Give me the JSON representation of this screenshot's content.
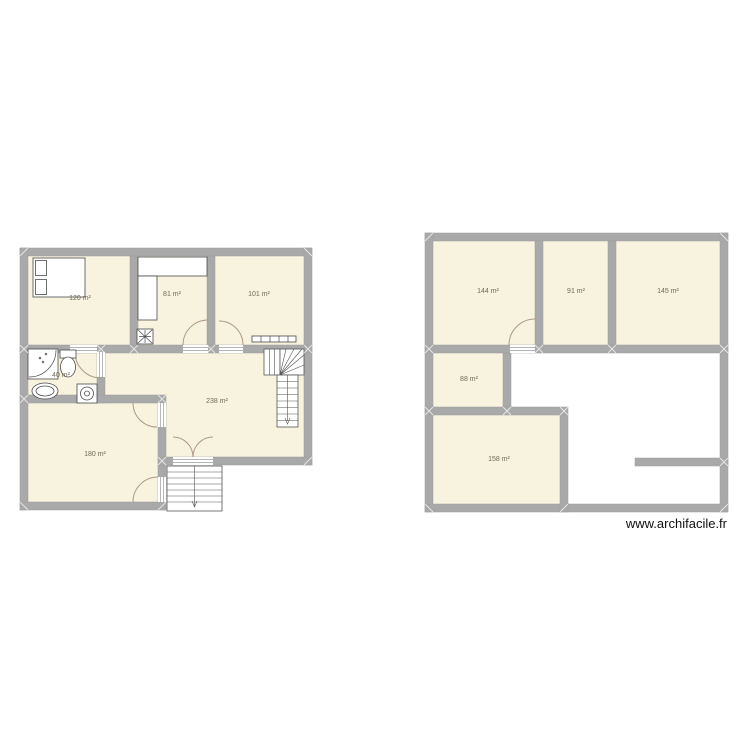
{
  "watermark": "www.archifacile.fr",
  "colors": {
    "wall": "#a9a9a9",
    "room_fill": "#f8f3de",
    "background": "#ffffff",
    "door_arc": "#ab9a85",
    "label_text": "#6e6a5a"
  },
  "floor_plan_left": {
    "rooms": [
      {
        "area_label": "120 m²"
      },
      {
        "area_label": "81 m²"
      },
      {
        "area_label": "101 m²"
      },
      {
        "area_label": "40 m²"
      },
      {
        "area_label": "238 m²"
      },
      {
        "area_label": "180 m²"
      }
    ]
  },
  "floor_plan_right": {
    "rooms": [
      {
        "area_label": "144 m²"
      },
      {
        "area_label": "91 m²"
      },
      {
        "area_label": "145 m²"
      },
      {
        "area_label": "88 m²"
      },
      {
        "area_label": "158 m²"
      }
    ]
  }
}
